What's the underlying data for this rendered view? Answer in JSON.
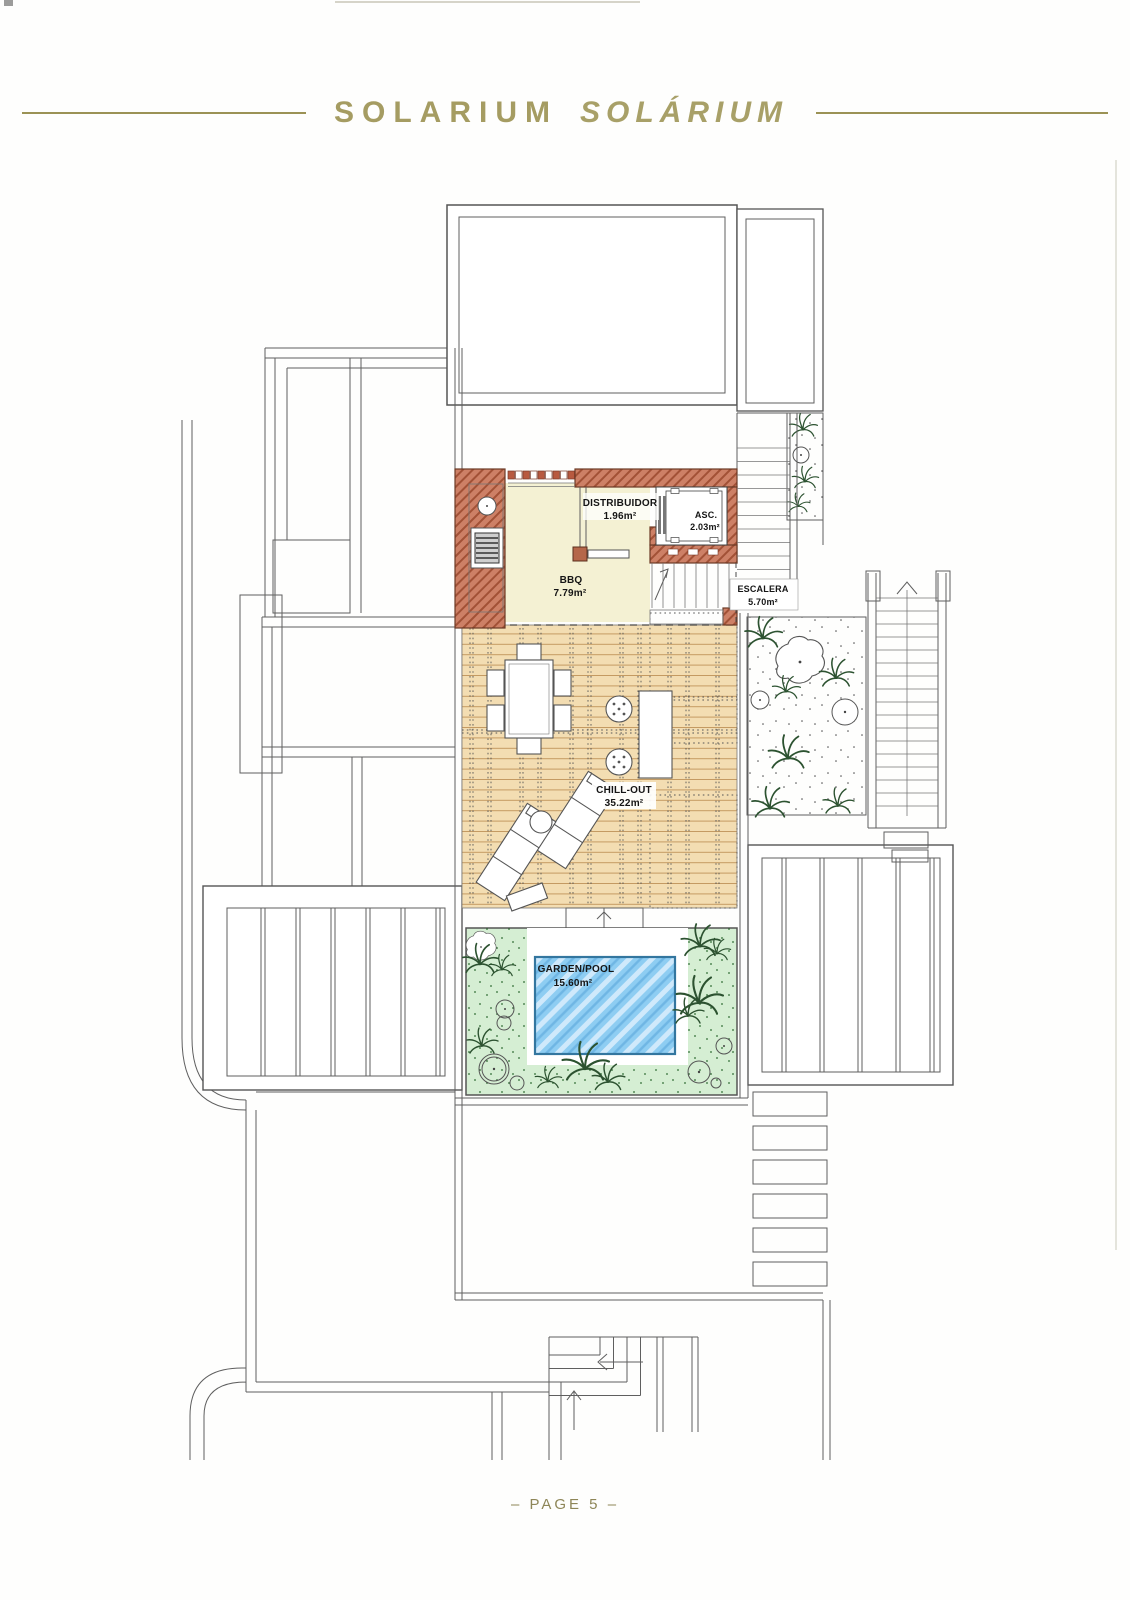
{
  "page": {
    "header": {
      "title_primary": "SOLARIUM",
      "title_secondary": "SOLÁRIUM"
    },
    "footer": {
      "page_label": "– PAGE 5 –"
    }
  },
  "plan": {
    "rooms": [
      {
        "id": "distribuidor",
        "name": "DISTRIBUIDOR",
        "area": "1.96m²"
      },
      {
        "id": "asc",
        "name": "ASC.",
        "area": "2.03m²"
      },
      {
        "id": "bbq",
        "name": "BBQ",
        "area": "7.79m²"
      },
      {
        "id": "escalera",
        "name": "ESCALERA",
        "area": "5.70m²"
      },
      {
        "id": "chill-out",
        "name": "CHILL-OUT",
        "area": "35.22m²"
      },
      {
        "id": "garden-pool",
        "name": "GARDEN/POOL",
        "area": "15.60m²"
      }
    ],
    "colors": {
      "accent_gold": "#a29a60",
      "wall_terracotta": "#cd8066",
      "floor_cream": "#f4f1d3",
      "deck_wood": "#f3ddb2",
      "garden_green": "#d5eed3",
      "pool_blue": "#8ecdf2"
    }
  }
}
